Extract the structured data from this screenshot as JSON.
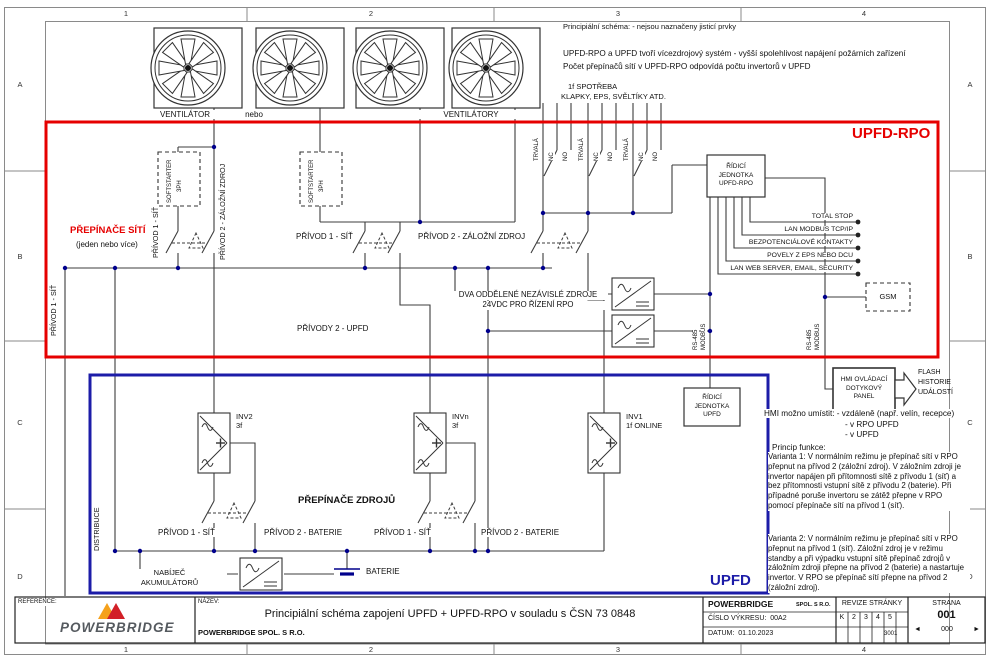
{
  "frame": {
    "cols": [
      "1",
      "2",
      "3",
      "4"
    ],
    "rows": [
      "A",
      "B",
      "C",
      "D"
    ]
  },
  "notes": {
    "schema_note": "Principiální schéma:  - nejsou naznačeny jisticí prvky",
    "multi_source_1": "UPFD-RPO a UPFD tvoří vícezdrojový systém - vyšší spolehlivost napájení požárních zařízení",
    "multi_source_2": "Počet přepínačů sítí v UPFD-RPO odpovídá počtu invertorů v UPFD",
    "consumers_1": "1f SPOTŘEBA",
    "consumers_2": "KLAPKY, EPS, SVĚLTÍKY ATD."
  },
  "fans": {
    "single": "VENTILÁTOR",
    "or": "nebo",
    "plural": "VENTILÁTORY"
  },
  "rpo": {
    "title": "UPFD-RPO",
    "softstarter_1": "SOFTSTARTER",
    "softstarter_2": "3PH",
    "net_switch_title": "PŘEPÍNAČE SÍTÍ",
    "net_switch_sub": "(jeden nebo více)",
    "feed1": "PŘÍVOD 1 - SÍŤ",
    "feed2": "PŘÍVOD 2 - ZÁLOŽNÍ ZDROJ",
    "feeds_upfd": "PŘÍVODY 2 - UPFD",
    "contact_permanent": "TRVALÁ",
    "contact_nc": "NC",
    "contact_no": "NO",
    "psu_line1": "DVA ODDĚLENÉ NEZÁVISLÉ ZDROJE",
    "psu_line2": "24VDC PRO ŘÍZENÍ RPO",
    "ctrl_line1": "ŘÍDICÍ",
    "ctrl_line2": "JEDNOTKA",
    "ctrl_line3": "UPFD-RPO",
    "outputs": [
      "TOTAL STOP",
      "LAN MODBUS TCP/IP",
      "BEZPOTENCIÁLOVÉ KONTAKTY",
      "POVELY Z EPS NEBO DCU",
      "LAN WEB SERVER, EMAIL, SECURITY"
    ],
    "gsm": "GSM",
    "rs485_1": "RS-485",
    "rs485_2": "MODBUS"
  },
  "upfd": {
    "title": "UPFD",
    "inv2_1": "INV2",
    "inv2_2": "3f",
    "invn_1": "INVn",
    "invn_2": "3f",
    "inv1_1": "INV1",
    "inv1_2": "1f ONLINE",
    "ctrl_line1": "ŘÍDICÍ",
    "ctrl_line2": "JEDNOTKA",
    "ctrl_line3": "UPFD",
    "source_switch_title": "PŘEPÍNAČE ZDROJŮ",
    "feed1": "PŘÍVOD 1 - SÍŤ",
    "feed2": "PŘÍVOD 2 - BATERIE",
    "charger_1": "NABÍJEČ",
    "charger_2": "AKUMULÁTORŮ",
    "battery": "BATERIE"
  },
  "left": {
    "distribution": "DISTRIBUCE"
  },
  "hmi": {
    "box_1": "HMI OVLÁDACÍ",
    "box_2": "DOTYKOVÝ",
    "box_3": "PANEL",
    "flash_1": "FLASH",
    "flash_2": "HISTORIE",
    "flash_3": "UDÁLOSTÍ",
    "placement": "HMI možno umístit: - vzdáleně (např. velín, recepce)",
    "placement2": "- v RPO UPFD",
    "placement3": "- v UPFD"
  },
  "principle": {
    "title": "Princip funkce:",
    "variant1": "Varianta 1: V normálním režimu je přepínač sítí v RPO přepnut na přívod 2 (záložní zdroj). V záložním zdroji je invertor napájen při přítomnosti sítě z přívodu 1 (síť) a bez přítomnosti vstupní sítě z přívodu 2 (baterie). Při případné poruše invertoru se zátěž přepne v RPO pomocí přepínače sítí na přívod 1 (síť).",
    "variant2": "Varianta 2: V normálním režimu je přepínač sítí v RPO přepnut na přívod 1 (síť). Záložní zdroj je v režimu standby a při výpadku vstupní sítě přepínač zdrojů v záložním zdroji přepne na přívod 2 (baterie) a nastartuje invertor. V RPO se přepínač sítí přepne na přívod 2 (záložní zdroj)."
  },
  "titleblock": {
    "reference_label": "REFERENCE:",
    "logo_text": "POWERBRIDGE",
    "nazev_label": "NÁZEV:",
    "title": "Principiální schéma zapojení UPFD + UPFD-RPO v souladu s ČSN 73 0848",
    "company_full": "POWERBRIDGE SPOL. S R.O.",
    "company_name": "POWERBRIDGE",
    "company_suffix": "SPOL. S R.O.",
    "drawing_no_label": "ČÍSLO VÝKRESU:",
    "drawing_no": "00A2",
    "date_label": "DATUM:",
    "date": "01.10.2023",
    "revisions_label": "REVIZE STRÁNKY",
    "rev_cells": [
      "K",
      "2",
      "3",
      "4",
      "5",
      ""
    ],
    "rev_cells2": [
      "",
      "",
      "",
      "",
      "3001",
      ""
    ],
    "page_label": "STRANA",
    "page": "001",
    "page_nav_prev": "◄",
    "page_nav": "000",
    "page_nav_next": "►"
  },
  "colors": {
    "rpo_border": "#e60000",
    "upfd_border": "#1c1ca8",
    "junction": "#00008c"
  }
}
